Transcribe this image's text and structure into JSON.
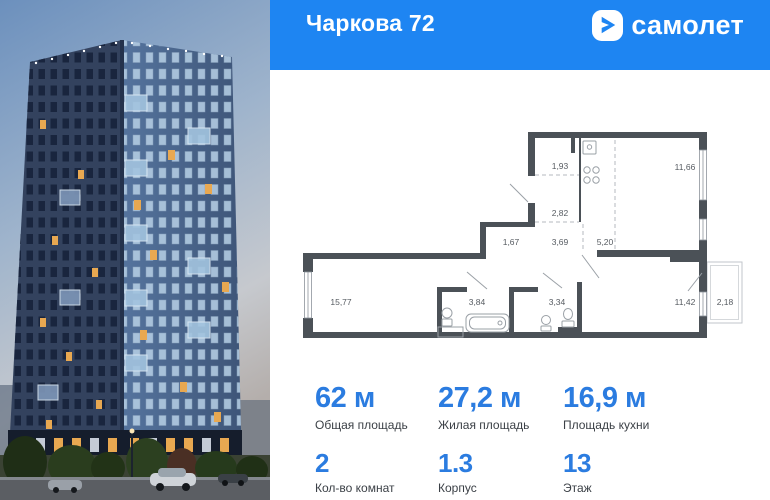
{
  "header": {
    "title": "Чаркова 72",
    "brand": "самолет"
  },
  "plan": {
    "rooms": [
      {
        "area": "1,93"
      },
      {
        "area": "11,66"
      },
      {
        "area": "2,82"
      },
      {
        "area": "1,67"
      },
      {
        "area": "3,69"
      },
      {
        "area": "5,20"
      },
      {
        "area": "15,77"
      },
      {
        "area": "3,84"
      },
      {
        "area": "3,34"
      },
      {
        "area": "11,42"
      },
      {
        "area": "2,18"
      }
    ]
  },
  "stats": {
    "items": [
      {
        "value": "62 м",
        "label": "Общая площадь"
      },
      {
        "value": "27,2 м",
        "label": "Жилая площадь"
      },
      {
        "value": "16,9 м",
        "label": "Площадь кухни"
      },
      {
        "value": "2",
        "label": "Кол-во комнат"
      },
      {
        "value": "1.3",
        "label": "Корпус"
      },
      {
        "value": "13",
        "label": "Этаж"
      }
    ]
  },
  "colors": {
    "brand_blue": "#1e85f2",
    "accent_blue": "#2b7ce0",
    "wall_gray": "#4b5157"
  }
}
